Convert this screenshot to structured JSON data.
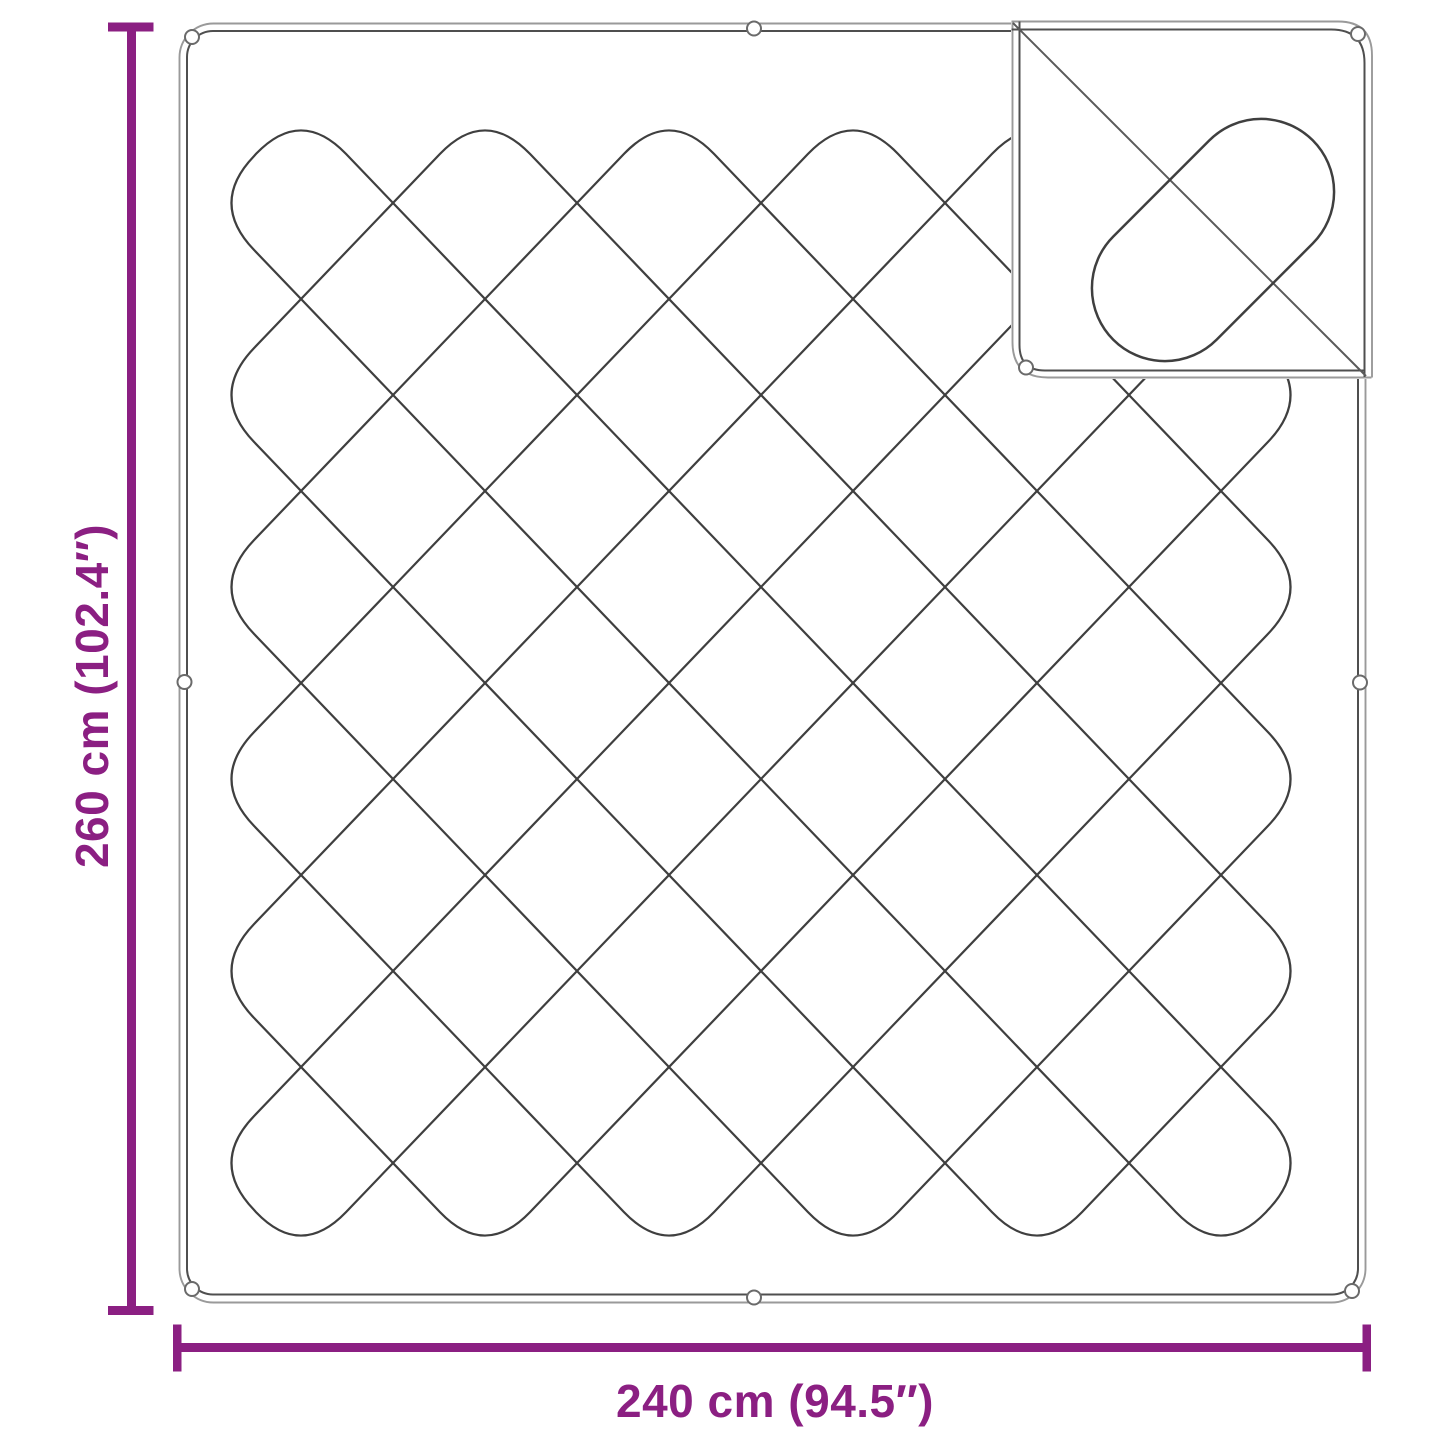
{
  "diagram": {
    "height_label": "260 cm (102.4″)",
    "width_label": "240 cm (94.5″)"
  },
  "colors": {
    "dimension": "#8b1f82",
    "outline_outer": "#9a9a9a",
    "outline_inner": "#4f4f4f",
    "stitch": "#3f3f3f",
    "crease": "#5a5a5a",
    "eyelet_stroke": "#6a6a6a",
    "background": "#ffffff"
  }
}
